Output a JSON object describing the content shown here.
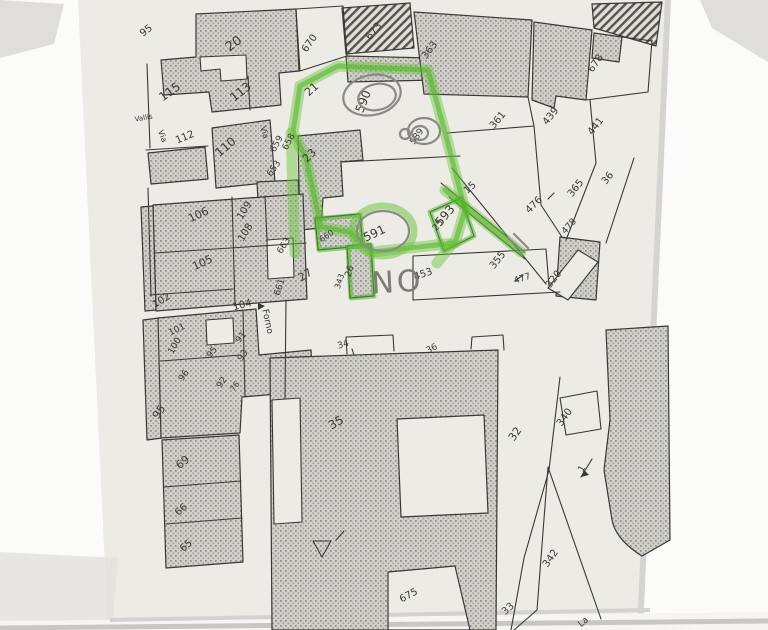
{
  "map": {
    "labels": [
      {
        "t": "95"
      },
      {
        "t": "20"
      },
      {
        "t": "670"
      },
      {
        "t": "673"
      },
      {
        "t": "363"
      },
      {
        "t": "678"
      },
      {
        "t": "115"
      },
      {
        "t": "113"
      },
      {
        "t": "21"
      },
      {
        "t": "590"
      },
      {
        "t": "589"
      },
      {
        "t": "361"
      },
      {
        "t": "439"
      },
      {
        "t": "441"
      },
      {
        "t": "Vallis"
      },
      {
        "t": "Via"
      },
      {
        "t": "112"
      },
      {
        "t": "110"
      },
      {
        "t": "Via"
      },
      {
        "t": "659"
      },
      {
        "t": "658"
      },
      {
        "t": "23"
      },
      {
        "t": "653"
      },
      {
        "t": "15"
      },
      {
        "t": "365"
      },
      {
        "t": "36"
      },
      {
        "t": "476"
      },
      {
        "t": "478"
      },
      {
        "t": "591"
      },
      {
        "t": "593"
      },
      {
        "t": "25"
      },
      {
        "t": "355"
      },
      {
        "t": "477"
      },
      {
        "t": "320"
      },
      {
        "t": "NO"
      },
      {
        "t": "453"
      },
      {
        "t": "660"
      },
      {
        "t": "26"
      },
      {
        "t": "343"
      },
      {
        "t": "106"
      },
      {
        "t": "109"
      },
      {
        "t": "108"
      },
      {
        "t": "105"
      },
      {
        "t": "663"
      },
      {
        "t": "27"
      },
      {
        "t": "661"
      },
      {
        "t": "102"
      },
      {
        "t": "104"
      },
      {
        "t": "Forno"
      },
      {
        "t": "101"
      },
      {
        "t": "100"
      },
      {
        "t": "91"
      },
      {
        "t": "95"
      },
      {
        "t": "93"
      },
      {
        "t": "96"
      },
      {
        "t": "92"
      },
      {
        "t": "76"
      },
      {
        "t": "95"
      },
      {
        "t": "69"
      },
      {
        "t": "66"
      },
      {
        "t": "65"
      },
      {
        "t": "34"
      },
      {
        "t": "36"
      },
      {
        "t": "35"
      },
      {
        "t": "32"
      },
      {
        "t": "340"
      },
      {
        "t": "1"
      },
      {
        "t": "342"
      },
      {
        "t": "675"
      },
      {
        "t": "33"
      },
      {
        "t": "La"
      }
    ],
    "highlighted_parcels": [
      "590",
      "591",
      "593",
      "25",
      "26"
    ],
    "handwritten_note": "NO"
  },
  "colors": {
    "highlighter_green": "#5ec53b",
    "paper": "#edebe6",
    "ink": "#3a3834",
    "pencil": "#7b7b77",
    "hatch_dark": "#8f8d89"
  }
}
